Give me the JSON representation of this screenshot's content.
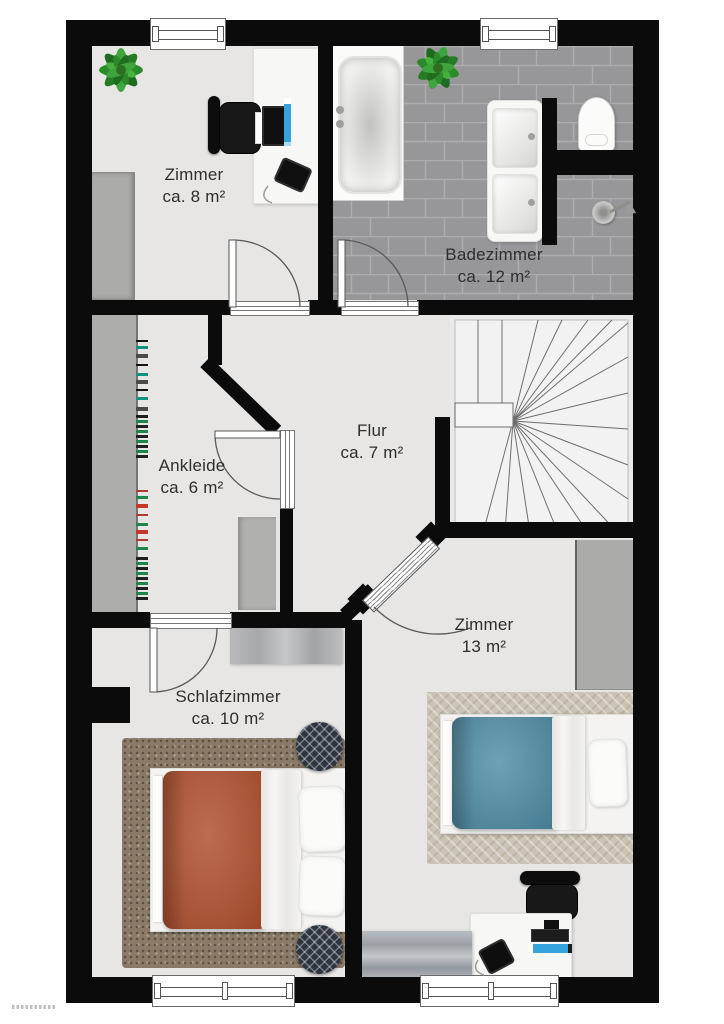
{
  "plan": {
    "type": "floor-plan",
    "language": "de",
    "rooms": [
      {
        "key": "zimmer-8",
        "name": "Zimmer",
        "area": "ca. 8 m²"
      },
      {
        "key": "badezimmer",
        "name": "Badezimmer",
        "area": "ca. 12 m²"
      },
      {
        "key": "ankleide",
        "name": "Ankleide",
        "area": "ca. 6 m²"
      },
      {
        "key": "flur",
        "name": "Flur",
        "area": "ca. 7 m²"
      },
      {
        "key": "schlafzimmer",
        "name": "Schlafzimmer",
        "area": "ca. 10 m²"
      },
      {
        "key": "zimmer-13",
        "name": "Zimmer",
        "area": "13 m²"
      }
    ]
  },
  "furniture": {
    "zimmer_8": [
      "potted-plant",
      "wardrobe",
      "desk",
      "office-chair",
      "monitor",
      "keyboard",
      "pc-tower",
      "telephone"
    ],
    "badezimmer": [
      "bathtub",
      "potted-plant",
      "double-washbasin",
      "toilet",
      "shower-head"
    ],
    "ankleide": [
      "built-in-wardrobe",
      "clothes-rail",
      "dresser"
    ],
    "flur": [
      "staircase"
    ],
    "schlafzimmer": [
      "double-bed",
      "rug",
      "pouf",
      "pouf",
      "sideboard"
    ],
    "zimmer_13": [
      "single-bed",
      "rug",
      "wardrobe",
      "desk",
      "office-chair",
      "monitor",
      "keyboard",
      "laptop",
      "telephone",
      "sideboard"
    ]
  },
  "colors": {
    "wall": "#0b0b0b",
    "floor": "#e7e6e4",
    "bath_tile": "#97979a",
    "tile_grout": "#adadaf",
    "red": "#b1502f",
    "blue": "#4e8ca4",
    "rug_brown": "#8a7b68",
    "rug_beige": "#cbc4b6",
    "plant_green": "#2c8a2b",
    "accent": "#35a3dc",
    "pouf": "#2e3440",
    "clothes": [
      "#141414",
      "#b03a2e",
      "#12917e",
      "#1e8449",
      "#4a4a4a",
      "#c0392b"
    ]
  }
}
